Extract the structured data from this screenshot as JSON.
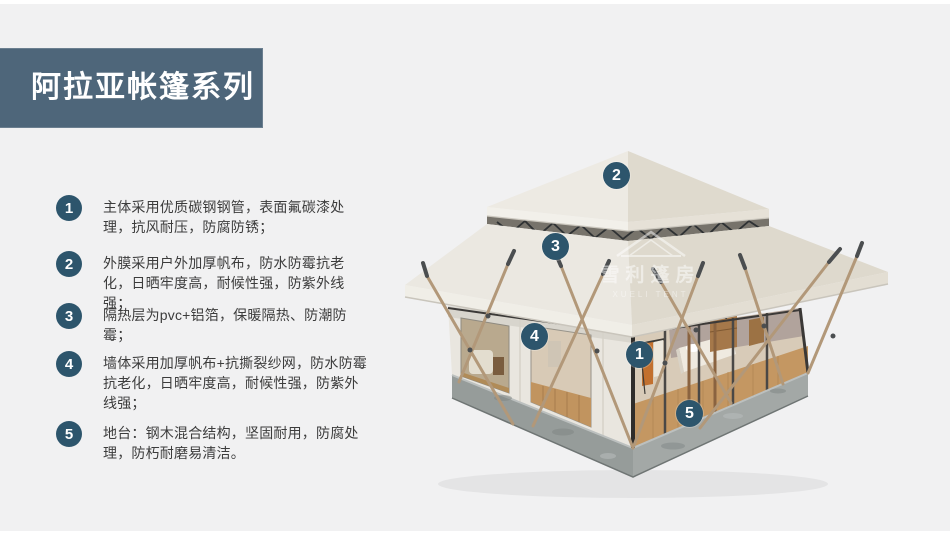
{
  "page": {
    "background": "#f1f1f2"
  },
  "header": {
    "title": "阿拉亚帐篷系列",
    "bg_color": "#4e667a",
    "text_color": "#ffffff"
  },
  "features": [
    {
      "num": "1",
      "text": "主体采用优质碳钢钢管，表面氟碳漆处理，抗风耐压，防腐防锈；"
    },
    {
      "num": "2",
      "text": "外膜采用户外加厚帆布，防水防霉抗老化，日晒牢度高，耐候性强，防紫外线强；"
    },
    {
      "num": "3",
      "text": "隔热层为pvc+铝箔，保暖隔热、防潮防霉；"
    },
    {
      "num": "4",
      "text": "墙体采用加厚帆布+抗撕裂纱网，防水防霉抗老化，日晒牢度高，耐候性强，防紫外线强；"
    },
    {
      "num": "5",
      "text": "地台：钢木混合结构，坚固耐用，防腐处理，防朽耐磨易清洁。"
    }
  ],
  "tent": {
    "markers": [
      {
        "num": "2"
      },
      {
        "num": "3"
      },
      {
        "num": "4"
      },
      {
        "num": "1"
      },
      {
        "num": "5"
      }
    ],
    "watermark": {
      "cn": "雪利篷房",
      "en": "XUELI TENT"
    }
  },
  "colors": {
    "accent": "#4e667a",
    "marker_bg": "#2d556c",
    "body_text": "#3c3c3c",
    "roof": "#edebe4",
    "platform": "#9aa09e",
    "pole": "#b29879"
  }
}
